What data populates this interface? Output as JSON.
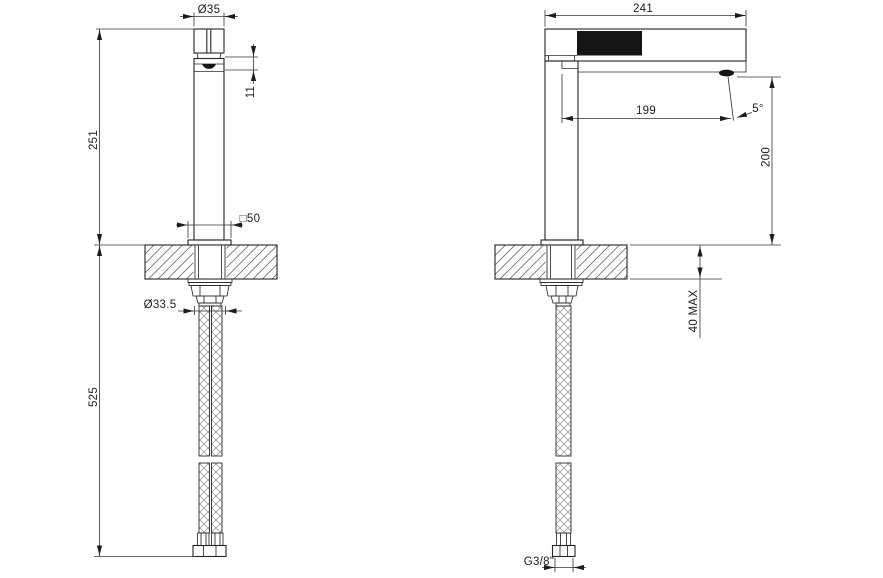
{
  "drawing": {
    "views": {
      "front": "front-view",
      "side": "side-view"
    },
    "dims": {
      "front": {
        "handle_diameter": "Ø35",
        "spout_outlet_height": "11",
        "body_height_above_deck": "251",
        "base_square": "□50",
        "shank_diameter": "33.5",
        "shank_diameter_label": "Ø33.5",
        "hose_drop_length": "525"
      },
      "side": {
        "total_depth": "241",
        "spout_reach": "199",
        "stream_angle": "5°",
        "spout_height": "200",
        "deck_thickness_max": "40 MAX",
        "hose_thread": "G3/8\""
      }
    },
    "colors": {
      "line": "#232323",
      "handle_fill": "#141414",
      "background": "#ffffff"
    }
  }
}
